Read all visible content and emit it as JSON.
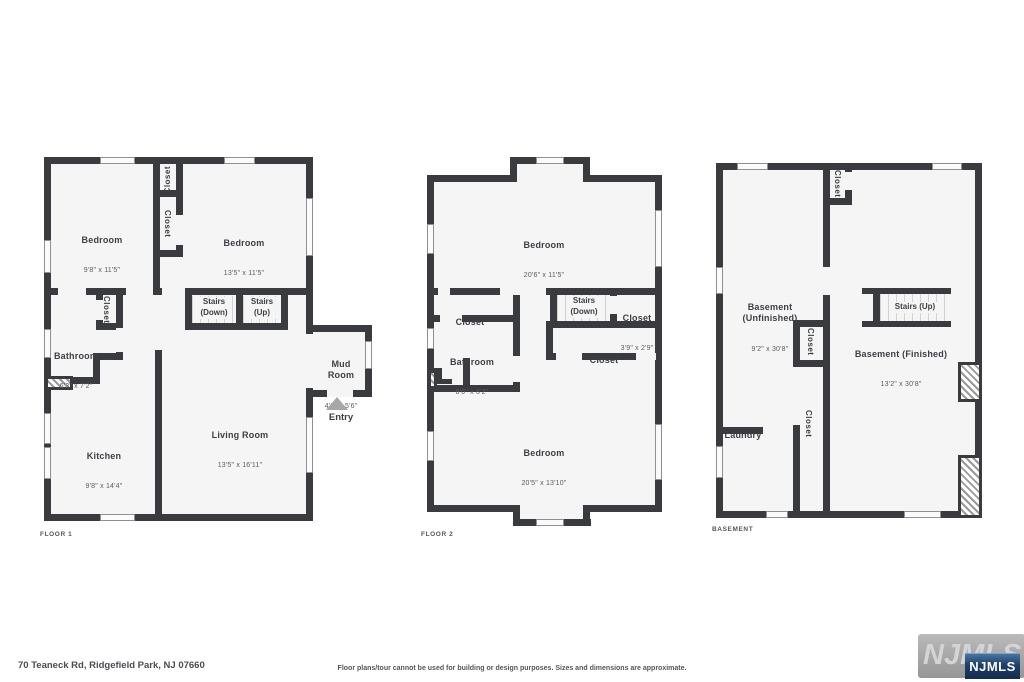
{
  "footer": {
    "address": "70 Teaneck Rd, Ridgefield Park, NJ 07660",
    "disclaimer": "Floor plans/tour cannot be used for building or design purposes. Sizes and dimensions are approximate.",
    "watermark_text": "NJMLS",
    "logo_text": "NJMLS"
  },
  "colors": {
    "wall": "#3a3b3f",
    "floor_fill": "#f5f5f6",
    "logo_blue": "#1d3f69",
    "watermark_gray": "#a8a8a8"
  },
  "floor1": {
    "title": "FLOOR 1",
    "bedroom1": {
      "name": "Bedroom",
      "dims": "9'8\" x 11'5\""
    },
    "bedroom2": {
      "name": "Bedroom",
      "dims": "13'5\" x 11'5\""
    },
    "closet_a": "Closet",
    "closet_b": "Closet",
    "closet_bath": "Closet",
    "stairs_down": "Stairs\n(Down)",
    "stairs_up": "Stairs\n(Up)",
    "bathroom": {
      "name": "Bathroom",
      "dims": "6'3\" x 7'2\""
    },
    "mud_room": {
      "name": "Mud\nRoom",
      "dims": "4'6\" x 5'6\""
    },
    "kitchen": {
      "name": "Kitchen",
      "dims": "9'8\" x 14'4\""
    },
    "living_room": {
      "name": "Living Room",
      "dims": "13'5\" x 16'11\""
    },
    "entry": "Entry"
  },
  "floor2": {
    "title": "FLOOR 2",
    "bedroom_top": {
      "name": "Bedroom",
      "dims": "20'6\" x 11'5\""
    },
    "closet_left": "Closet",
    "stairs_down": "Stairs\n(Down)",
    "closet_right": {
      "name": "Closet",
      "dims": "3'9\" x 2'9\""
    },
    "closet_center": "Closet",
    "bathroom": {
      "name": "Bathroom",
      "dims": "8'0\" x 6'2\""
    },
    "bedroom_bottom": {
      "name": "Bedroom",
      "dims": "20'5\" x 13'10\""
    }
  },
  "basement": {
    "title": "BASEMENT",
    "closet_top": "Closet",
    "unfinished": {
      "name": "Basement\n(Unfinished)",
      "dims": "9'2\" x 30'8\""
    },
    "stairs_up": "Stairs (Up)",
    "finished": {
      "name": "Basement (Finished)",
      "dims": "13'2\" x 30'8\""
    },
    "closet_mid": "Closet",
    "laundry": "Laundry",
    "closet_low": "Closet"
  }
}
